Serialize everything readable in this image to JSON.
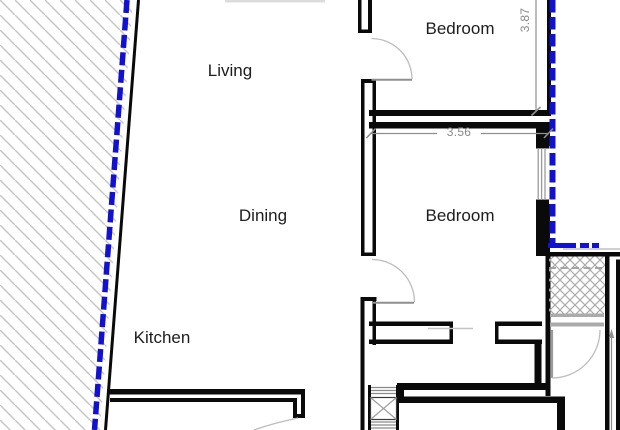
{
  "labels": {
    "living": "Living",
    "dining": "Dining",
    "kitchen": "Kitchen",
    "bedroom_top": "Bedroom",
    "bedroom_mid": "Bedroom"
  },
  "dimensions": {
    "bedroom_top_depth": "3.87",
    "bedroom_mid_width": "3.56"
  },
  "colors": {
    "wall_black": "#0a0a0a",
    "boundary_blue": "#1111cf",
    "dimension_gray": "#8f8f8f",
    "hatch_gray": "#c6c6c6",
    "door_arc_gray": "#bdbdbd"
  }
}
